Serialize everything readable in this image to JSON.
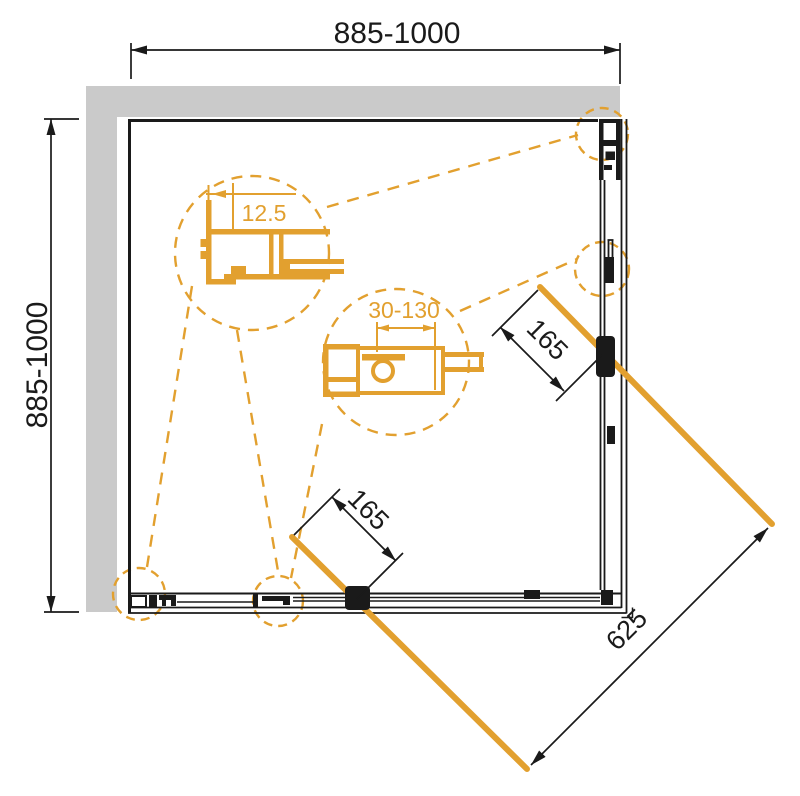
{
  "drawing": {
    "type": "shower-enclosure-plan-technical-drawing",
    "colors": {
      "accent_orange": "#e2a02f",
      "line_black": "#1a1a1a",
      "wall_gray": "#cacaca",
      "background": "#ffffff"
    },
    "labels": {
      "width_top": "885-1000",
      "depth_left": "885-1000",
      "detail_wall_profile": "12.5",
      "detail_adjustment_range": "30-130",
      "handle_right_length": "165",
      "handle_bottom_length": "165",
      "diagonal_entry": "625"
    }
  }
}
